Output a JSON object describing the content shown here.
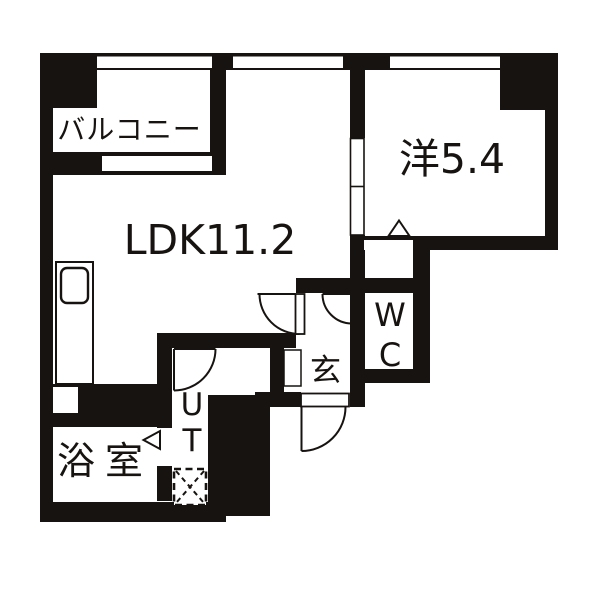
{
  "floorplan": {
    "title": "apartment floor plan",
    "rooms": {
      "balcony": {
        "label": "バルコニー"
      },
      "ldk": {
        "label": "LDK11.2",
        "size_tatami": "11.2"
      },
      "western_room": {
        "label": "洋5.4",
        "size_tatami": "5.4"
      },
      "wc": {
        "label": "WC"
      },
      "entrance": {
        "label": "玄"
      },
      "utility": {
        "label": "UT"
      },
      "bathroom": {
        "label": "浴室"
      }
    },
    "colors": {
      "wall": "#171310",
      "floor": "#ffffff"
    }
  }
}
